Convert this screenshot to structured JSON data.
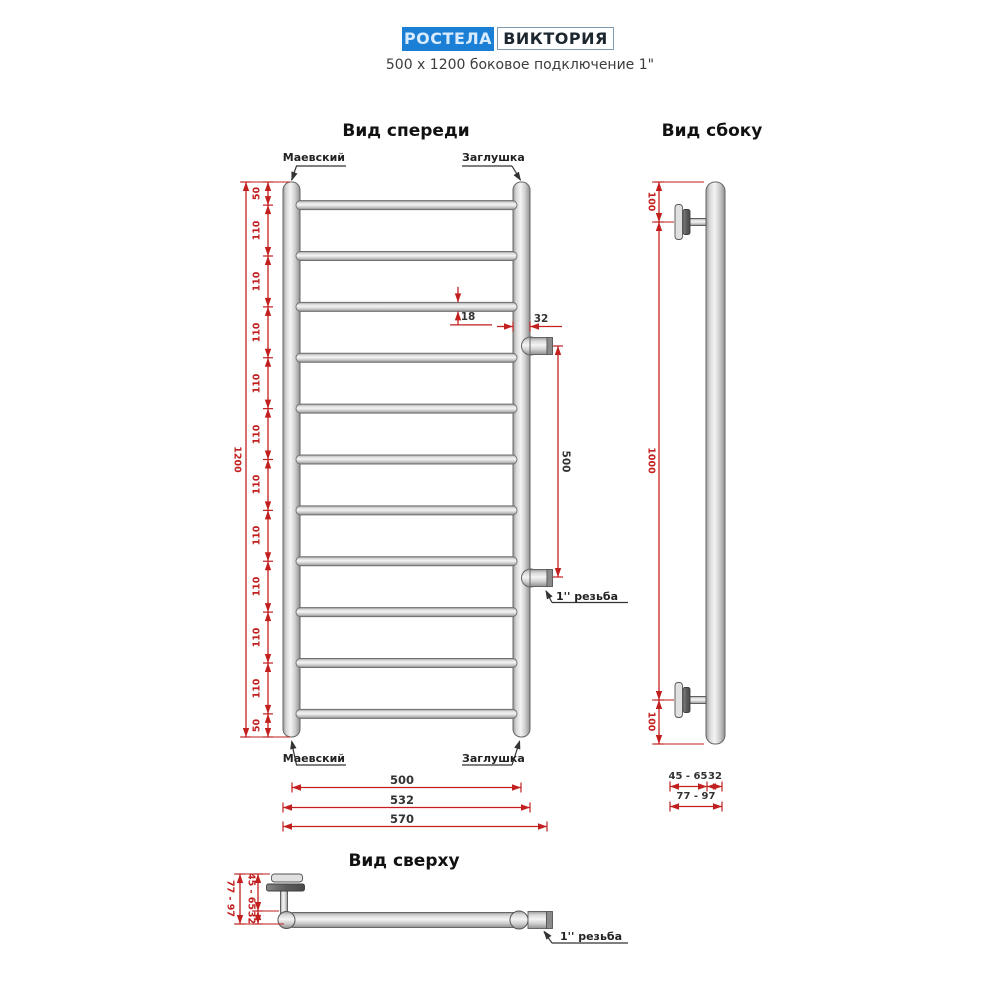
{
  "colors": {
    "red": "#c21f1f",
    "dark": "#333333",
    "brand_blue": "#1b7fd6"
  },
  "header": {
    "brand": "РОСТЕЛА",
    "model": "ВИКТОРИЯ",
    "subtitle": "500 x 1200 боковое подключение 1\""
  },
  "front_view": {
    "title": "Вид спереди",
    "labels": {
      "top_left": "Маевский",
      "top_right": "Заглушка",
      "bottom_left": "Маевский",
      "bottom_right": "Заглушка",
      "thread": "1'' резьба"
    },
    "dimensions": {
      "height_segments": [
        "50",
        "110",
        "110",
        "110",
        "110",
        "110",
        "110",
        "110",
        "110",
        "110",
        "110",
        "50"
      ],
      "total_height": "1200",
      "rung_diameter": "18",
      "collector_diameter": "32",
      "connection_spacing": "500",
      "widths": [
        "500",
        "532",
        "570"
      ]
    },
    "rung_count": 11
  },
  "side_view": {
    "title": "Вид сбоку",
    "dimensions": {
      "top_offset": "100",
      "middle": "1000",
      "bottom_offset": "100",
      "wall_gap": "45 - 65",
      "tube": "32",
      "total_depth": "77 - 97"
    }
  },
  "top_view": {
    "title": "Вид сверху",
    "dimensions": {
      "total_depth": "77 - 97",
      "wall_gap": "45 - 65",
      "tube": "32"
    },
    "thread": "1'' резьба"
  }
}
